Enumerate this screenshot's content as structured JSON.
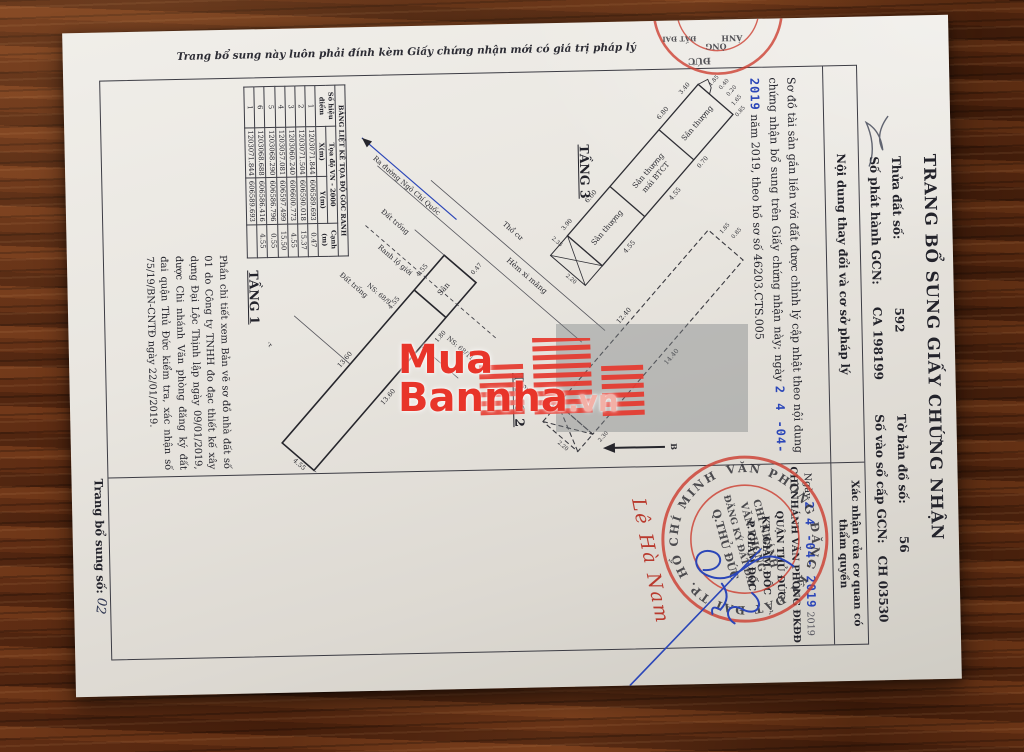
{
  "watermark": {
    "line1": "Mua",
    "line2": "Bannha",
    "suffix": ".vn"
  },
  "doc": {
    "side_note": "Trang bổ sung này luôn phải đính kèm Giấy chứng nhận mới có giá trị pháp lý",
    "title": "TRANG BỔ SUNG GIẤY CHỨNG NHẬN",
    "fields": {
      "thua_dat_label": "Thửa đất số:",
      "thua_dat_value": "592",
      "to_ban_do_label": "Tờ bản đồ số:",
      "to_ban_do_value": "56",
      "so_phat_hanh_label": "Số phát hành GCN:",
      "so_phat_hanh_value": "CA 198199",
      "so_vao_so_label": "Số vào sổ cấp GCN:",
      "so_vao_so_value": "CH 03530"
    },
    "table": {
      "col1_header": "Nội dung thay đổi và cơ sở pháp lý",
      "col2_header": "Xác nhận của cơ quan có thẩm quyền"
    },
    "content": {
      "para_1": "Sơ đồ tài sản gắn liền với đất được chỉnh lý cập nhật theo nội dung chứng nhận bổ sung trên Giấy chứng nhận này; ngày",
      "para_stamp": "2 4  -04- 2019",
      "para_2": "năm 2019, theo hồ sơ số 46203.CTS.005",
      "note": "Phần chi tiết xem Bản vẽ sơ đồ nhà đất số 01 do Công ty TNHH đo đạc thiết kế xây dựng Đại Lộc Thịnh lập ngày 09/01/2019, được Chi nhánh Văn phòng đăng ký đất đai quận Thủ Đức kiểm tra, xác nhận số 75/19/BN-CNTĐ ngày 22/01/2019."
    },
    "plans": {
      "tang1_label": "TẦNG 1",
      "tang2_label": "TẦNG 2",
      "tang3_label": "TẦNG 3",
      "san": "Sân",
      "san_thuong": "Sân thượng",
      "mai_btct": "mái BTCT",
      "tho_cu": "Thổ cư",
      "dat_trong": "Đất trống",
      "ns_1": "NS: 68/9",
      "ns_2": "NS: 68/11",
      "hem": "Hẻm xi măng",
      "ra_duong": "Ra đường Ngô Chí Quốc",
      "ranh_lo_gioi": "Ranh lộ giới",
      "north": "B",
      "dims": {
        "d1360": "13.60",
        "d455": "4.55",
        "d047": "0.47",
        "d180": "1.80",
        "d1240": "12.40",
        "d1440": "14.40",
        "d660": "6.60",
        "d680": "6.80",
        "d340": "3.40",
        "d390": "3.90",
        "d070": "0.70",
        "d235": "2.35",
        "d220": "2.20",
        "d230": "2.30",
        "d185": "1.85",
        "d040": "0.40",
        "d020": "0.20",
        "d165": "1.65",
        "d085": "0.85"
      }
    },
    "coord_table": {
      "title": "BẢNG LIỆT KÊ TỌA ĐỘ GÓC RANH",
      "col_point": "Số hiệu điểm",
      "col_group": "Tọa độ VN - 2000",
      "col_x": "X(m)",
      "col_y": "Y(m)",
      "col_edge": "Cạnh (m)",
      "rows": [
        [
          "1",
          "1203071.844",
          "606589.693",
          "0.47"
        ],
        [
          "2",
          "1203071.504",
          "606590.018",
          "15.37"
        ],
        [
          "3",
          "1203060.240",
          "606600.773",
          "4.55"
        ],
        [
          "4",
          "1203057.081",
          "606597.499",
          "15.50"
        ],
        [
          "5",
          "1203068.290",
          "606586.796",
          "0.55"
        ],
        [
          "6",
          "1203068.688",
          "606586.416",
          "4.55"
        ],
        [
          "1",
          "1203071.844",
          "606589.693",
          ""
        ]
      ]
    },
    "confirm": {
      "date_prefix": "Ngày",
      "date_stamp": "2 4  -04- 2019",
      "date_suffix": "2019",
      "org_1": "CHI NHÁNH VĂN PHÒNG ĐKĐĐ",
      "org_2": "QUẬN THỦ ĐỨC",
      "org_3": "KT. GIÁM ĐỐC",
      "org_4": "P. GIÁM ĐỐC",
      "signer": "Lê Hà Nam",
      "stamp_ring": "VĂN PHÒNG ĐĂNG KÝ ĐẤT ĐAI TP. HỒ CHÍ MINH ★",
      "stamp_line1": "CHI NHÁNH",
      "stamp_line2": "VĂN PHÒNG",
      "stamp_line3": "ĐĂNG KÝ ĐẤT ĐAI",
      "stamp_line4": "Q.THỦ ĐỨC"
    },
    "edge_stamp": {
      "t1": "ÁNH",
      "t2": "ÒNG",
      "t3": "ĐẤT ĐAI",
      "t4": "ĐỨC"
    },
    "page_note": {
      "label": "Trang bổ sung số:",
      "value": "02"
    }
  },
  "colors": {
    "stamp_red": "#cd4033",
    "ink_blue": "#2b46b8",
    "watermark_red": "#e8352a"
  }
}
